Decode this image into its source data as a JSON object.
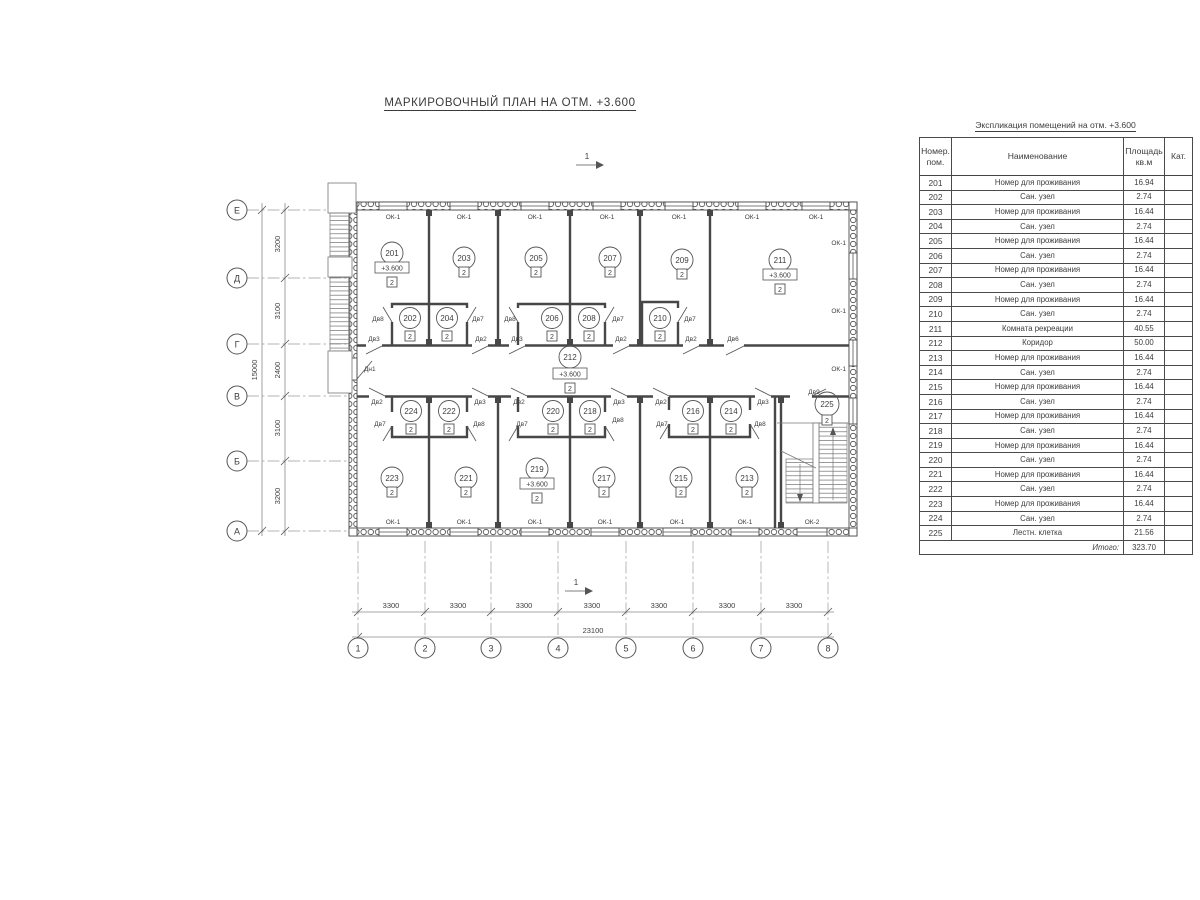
{
  "page": {
    "title": "МАРКИРОВОЧНЫЙ ПЛАН НА ОТМ. +3.600"
  },
  "plan": {
    "category_mark": "2",
    "section_mark": "1",
    "rooms": [
      {
        "n": "201",
        "elev": "+3.600"
      },
      {
        "n": "202"
      },
      {
        "n": "203"
      },
      {
        "n": "204"
      },
      {
        "n": "205"
      },
      {
        "n": "206"
      },
      {
        "n": "207"
      },
      {
        "n": "208"
      },
      {
        "n": "209"
      },
      {
        "n": "210"
      },
      {
        "n": "211",
        "elev": "+3.600"
      },
      {
        "n": "212",
        "elev": "+3.600"
      },
      {
        "n": "213"
      },
      {
        "n": "214"
      },
      {
        "n": "215"
      },
      {
        "n": "216"
      },
      {
        "n": "217"
      },
      {
        "n": "218"
      },
      {
        "n": "219",
        "elev": "+3.600"
      },
      {
        "n": "220"
      },
      {
        "n": "221"
      },
      {
        "n": "222"
      },
      {
        "n": "223"
      },
      {
        "n": "224"
      },
      {
        "n": "225"
      }
    ],
    "axis_rows": [
      "Е",
      "Д",
      "Г",
      "В",
      "Б",
      "А"
    ],
    "axis_cols": [
      "1",
      "2",
      "3",
      "4",
      "5",
      "6",
      "7",
      "8"
    ],
    "v_dims": [
      "3200",
      "3100",
      "2400",
      "3100",
      "3200"
    ],
    "v_total": "15000",
    "h_dims": [
      "3300",
      "3300",
      "3300",
      "3300",
      "3300",
      "3300",
      "3300"
    ],
    "h_total": "23100",
    "labels": {
      "window1": "ОК-1",
      "window2": "ОК-2",
      "doors": {
        "d1": "Дв1",
        "d2": "Дв2",
        "d3": "Дв3",
        "d6": "Дв6",
        "d7": "Дв7",
        "d8": "Дв8",
        "d9": "Дв9",
        "dn1": "Дн1"
      }
    }
  },
  "table": {
    "caption": "Экспликация помещений на отм. +3.600",
    "col_num": "Номер. пом.",
    "col_name": "Наименование",
    "col_area": "Площадь кв.м",
    "col_cat": "Кат.",
    "rows": [
      {
        "num": "201",
        "name": "Номер для проживания",
        "area": "16.94"
      },
      {
        "num": "202",
        "name": "Сан. узел",
        "area": "2.74"
      },
      {
        "num": "203",
        "name": "Номер для проживания",
        "area": "16.44"
      },
      {
        "num": "204",
        "name": "Сан. узел",
        "area": "2.74"
      },
      {
        "num": "205",
        "name": "Номер для проживания",
        "area": "16.44"
      },
      {
        "num": "206",
        "name": "Сан. узел",
        "area": "2.74"
      },
      {
        "num": "207",
        "name": "Номер для проживания",
        "area": "16.44"
      },
      {
        "num": "208",
        "name": "Сан. узел",
        "area": "2.74"
      },
      {
        "num": "209",
        "name": "Номер для проживания",
        "area": "16.44"
      },
      {
        "num": "210",
        "name": "Сан. узел",
        "area": "2.74"
      },
      {
        "num": "211",
        "name": "Комната рекреации",
        "area": "40.55"
      },
      {
        "num": "212",
        "name": "Коридор",
        "area": "50.00"
      },
      {
        "num": "213",
        "name": "Номер для проживания",
        "area": "16.44"
      },
      {
        "num": "214",
        "name": "Сан. узел",
        "area": "2.74"
      },
      {
        "num": "215",
        "name": "Номер для проживания",
        "area": "16.44"
      },
      {
        "num": "216",
        "name": "Сан. узел",
        "area": "2.74"
      },
      {
        "num": "217",
        "name": "Номер для проживания",
        "area": "16.44"
      },
      {
        "num": "218",
        "name": "Сан. узел",
        "area": "2.74"
      },
      {
        "num": "219",
        "name": "Номер для проживания",
        "area": "16.44"
      },
      {
        "num": "220",
        "name": "Сан. узел",
        "area": "2.74"
      },
      {
        "num": "221",
        "name": "Номер для проживания",
        "area": "16.44"
      },
      {
        "num": "222",
        "name": "Сан. узел",
        "area": "2.74"
      },
      {
        "num": "223",
        "name": "Номер для проживания",
        "area": "16.44"
      },
      {
        "num": "224",
        "name": "Сан. узел",
        "area": "2.74"
      },
      {
        "num": "225",
        "name": "Лестн. клетка",
        "area": "21.56"
      }
    ],
    "total_label": "Итого:",
    "total_area": "323.70"
  }
}
